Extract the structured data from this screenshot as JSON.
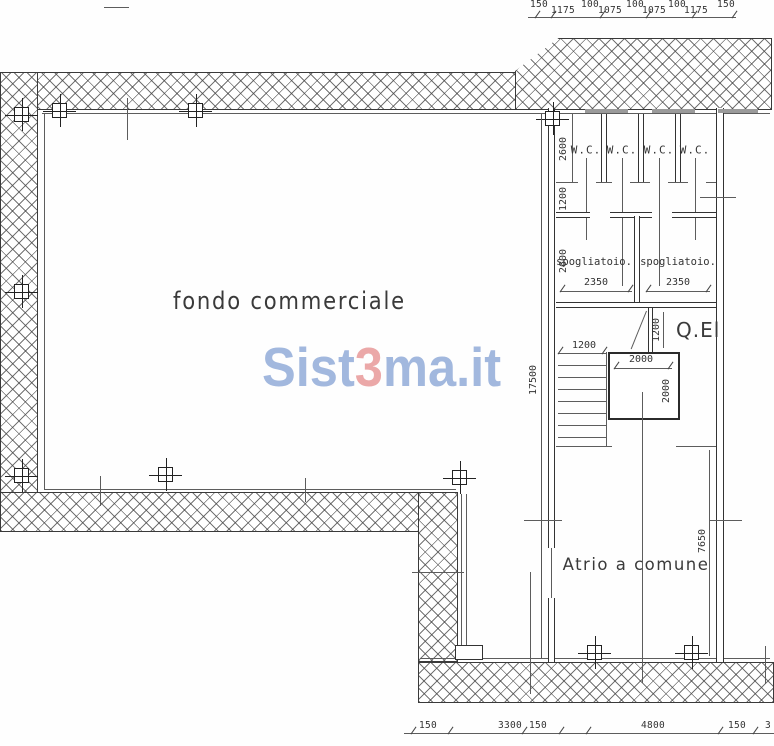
{
  "rooms": {
    "main": "fondo commerciale",
    "atrium": "Atrio a comune",
    "electrical_panel": "Q.El",
    "wc": [
      "W.C.",
      "W.C.",
      "W.C.",
      "W.C."
    ],
    "changing_left": "spogliatoio.",
    "changing_right": "spogliatoio."
  },
  "watermark": {
    "prefix": "Sist",
    "accent": "3",
    "suffix": "ma.it"
  },
  "dimensions": {
    "top_row": [
      "150",
      "1175",
      "100",
      "1075",
      "100",
      "1075",
      "100",
      "1175",
      "150"
    ],
    "bottom_row": [
      "150",
      "3300",
      "150",
      "4800",
      "150",
      "3"
    ],
    "overall_height": "17500",
    "atrium_height": "7650",
    "wc_zone_depth": "2600",
    "wc_corridor": "1200",
    "changing_depth": "2600",
    "changing_width_left": "2350",
    "changing_width_right": "2350",
    "stair_flight_width": "1200",
    "elevator_width": "2000",
    "elevator_depth": "2000",
    "elevator_side": "1200"
  },
  "colors": {
    "ink": "#333333",
    "watermark_blue": "#93acd9",
    "watermark_red": "#e89a9a"
  }
}
